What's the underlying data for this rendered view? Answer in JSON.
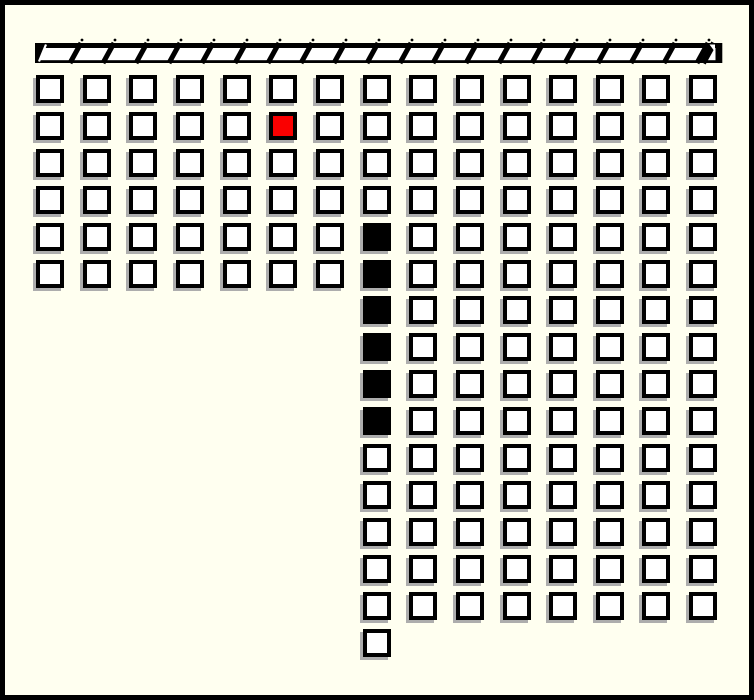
{
  "board": {
    "cols": 15,
    "rows": 16,
    "legend": {
      "O": "open",
      "R": "red",
      "B": "black",
      ".": "empty"
    },
    "grid": [
      "OOOOOOOOOOOOOOO",
      "OOOOOROOOOOOOOO",
      "OOOOOOOOOOOOOOO",
      "OOOOOOOOOOOOOOO",
      "OOOOOOOBOOOOOOO",
      "OOOOOOOBOOOOOOO",
      ".......BOOOOOOO",
      ".......BOOOOOOO",
      ".......BOOOOOOO",
      ".......BOOOOOOO",
      ".......OOOOOOOO",
      ".......OOOOOOOO",
      ".......OOOOOOOO",
      ".......OOOOOOOO",
      ".......OOOOOOOO",
      ".......O......."
    ],
    "counts": {
      "open": 156,
      "red": 1,
      "black": 6
    }
  },
  "top_bar": {
    "hatch_count": 20
  },
  "colors": {
    "background": "#FFFFF0",
    "cell_fill": "#FFFFFF",
    "outline": "#000000",
    "red_fill": "#FA0000",
    "black_fill": "#000000",
    "shadow": "#ADADAD"
  }
}
